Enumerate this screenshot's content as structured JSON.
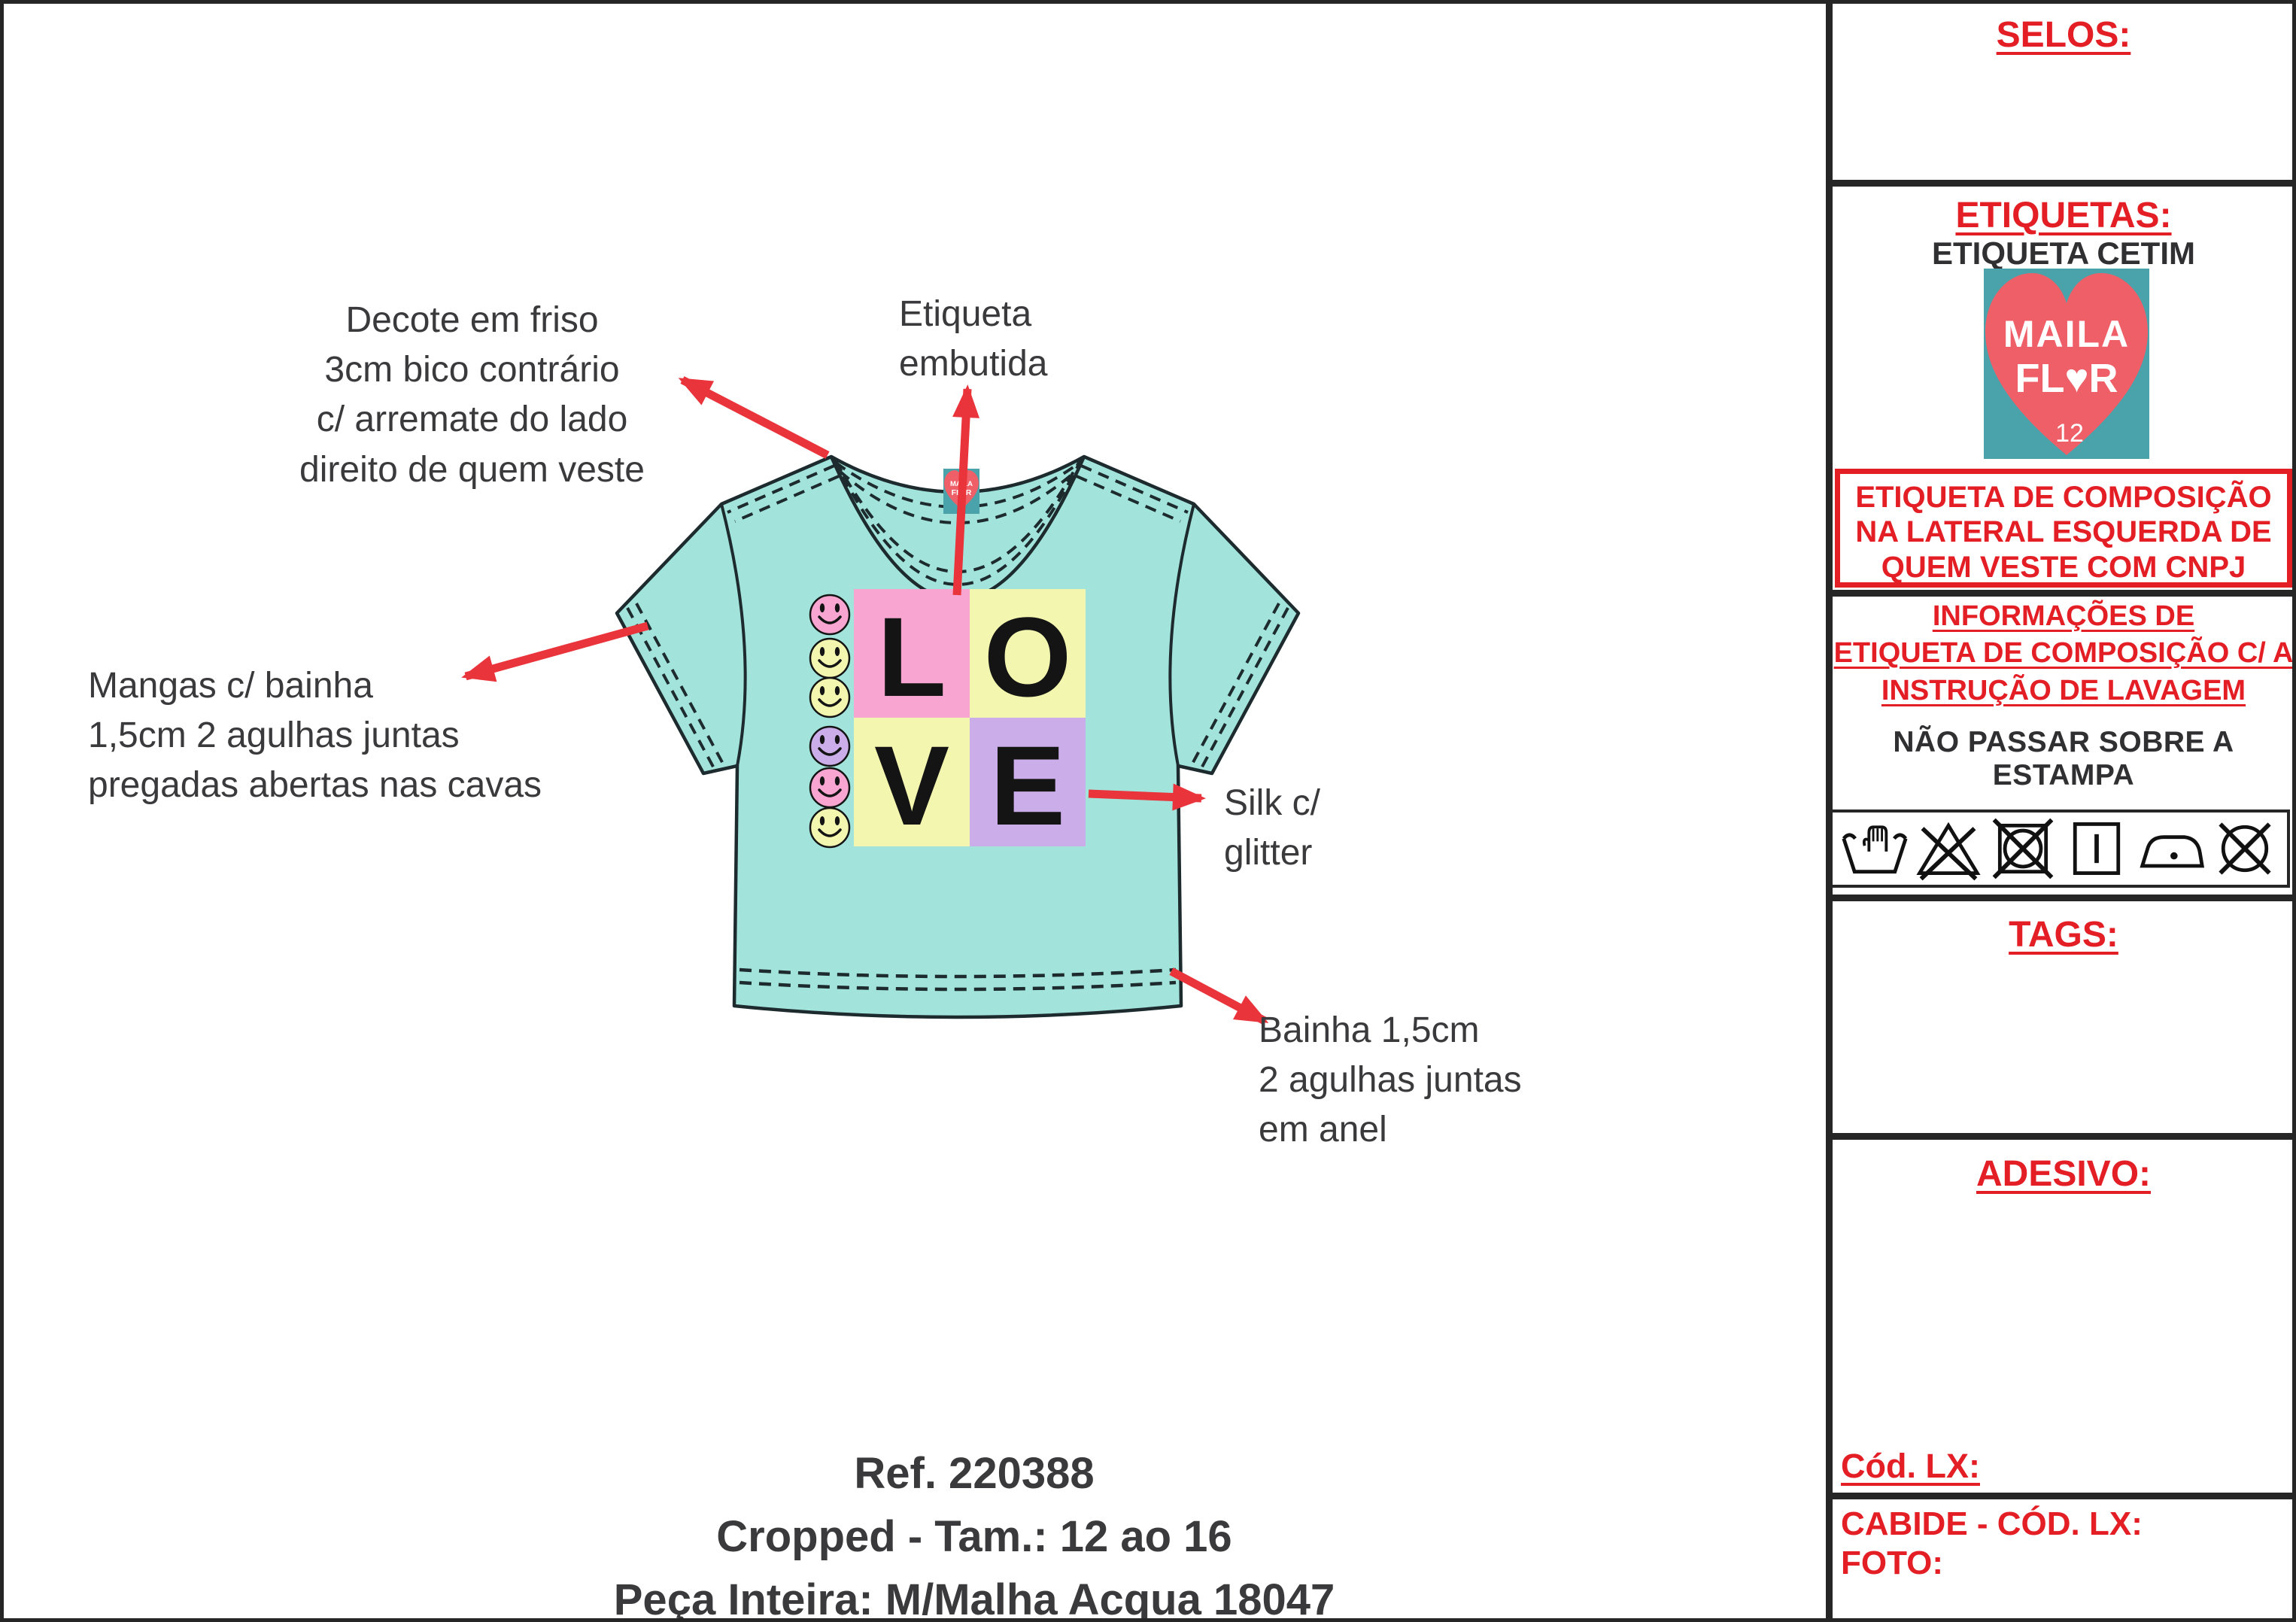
{
  "colors": {
    "accent_red": "#e41e25",
    "arrow_red": "#ea343b",
    "shirt_mint": "#a2e4db",
    "outline_dark": "#1d2b2e",
    "square_pink": "#f8a6d1",
    "square_yellow": "#f3f6ae",
    "square_purple": "#caade9",
    "label_teal": "#4aa2aa",
    "heart_coral": "#ef5f68",
    "text_dark": "#3a3a3c"
  },
  "annotations": {
    "neckline": "Decote em friso\n3cm bico contrário\nc/ arremate do lado\ndireito de quem veste",
    "neck_label": "Etiqueta\nembutida",
    "sleeves": "Mangas c/ bainha\n1,5cm 2 agulhas juntas\npregadas abertas nas cavas",
    "print": "Silk c/\nglitter",
    "hem": "Bainha 1,5cm\n2 agulhas juntas\nem anel"
  },
  "footer": {
    "ref": "Ref. 220388",
    "size_range": "Cropped - Tam.: 12 ao 16",
    "fabric": "Peça Inteira:  M/Malha Acqua 18047"
  },
  "shirt": {
    "graphic": {
      "letters": [
        "L",
        "O",
        "V",
        "E"
      ],
      "smiley_colors": [
        "#f8a6d1",
        "#f3f6ae",
        "#f3f6ae",
        "#caade9",
        "#f8a6d1",
        "#f3f6ae"
      ]
    },
    "neck_tag": {
      "line1": "MAILA",
      "line2": "FL♥R",
      "size": "12"
    }
  },
  "panel": {
    "selos_header": "SELOS:",
    "etiquetas_header": "ETIQUETAS:",
    "etiqueta_type": "ETIQUETA CETIM",
    "brand_label": {
      "line1": "MAILA",
      "line2": "FL♥R",
      "size": "12"
    },
    "composition_box": "ETIQUETA DE COMPOSIÇÃO NA LATERAL ESQUERDA DE QUEM VESTE COM CNPJ",
    "info_header": "INFORMAÇÕES DE\nETIQUETA DE COMPOSIÇÃO C/ A\nINSTRUÇÃO DE LAVAGEM",
    "print_warning": "NÃO PASSAR SOBRE A ESTAMPA",
    "care_icons": [
      "hand-wash",
      "do-not-bleach",
      "do-not-tumble-dry",
      "line-dry",
      "iron-low-temp",
      "do-not-dry-clean"
    ],
    "tags_header": "TAGS:",
    "adesivo_header": "ADESIVO:",
    "cod_lx": "Cód. LX:",
    "cabide": "CABIDE - CÓD. LX:",
    "foto": "FOTO:"
  }
}
